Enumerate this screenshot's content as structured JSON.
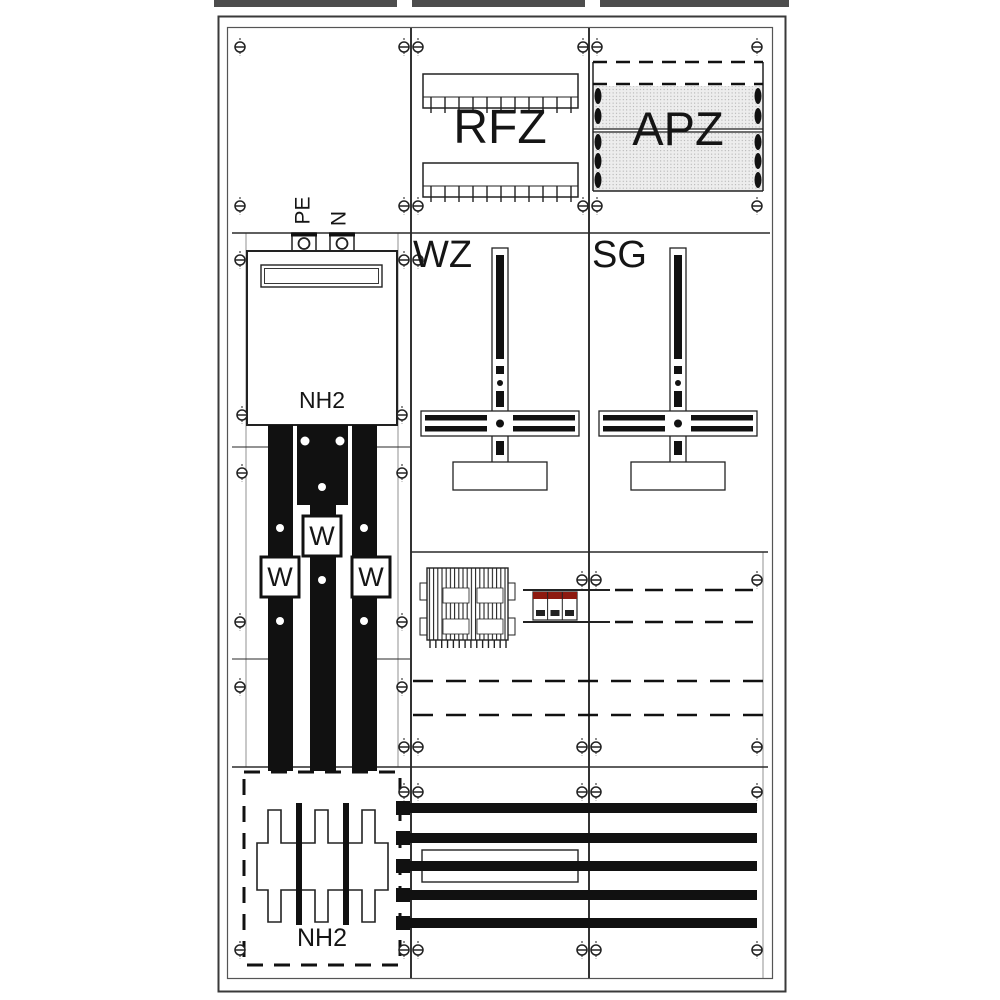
{
  "figure": {
    "type": "electrical-distribution-board-front-view",
    "labels": {
      "din_rail_field": "RFZ",
      "apz_field": "APZ",
      "meter_field_left": "WZ",
      "meter_field_right": "SG",
      "pe_terminal": "PE",
      "n_terminal": "N",
      "nh_fuse_top": "NH2",
      "nh_fuse_bottom": "NH2",
      "current_transformer": "W"
    },
    "colors": {
      "line": "#1e1e1e",
      "frame": "#3a3a3a",
      "top_band": "#4d4d4d",
      "breaker_red": "#8d1a10",
      "stipple_bg": "#ededed"
    },
    "counts": {
      "current_transformers": 3,
      "bottom_busbars": 5,
      "meter_crosses": 2,
      "din_rails": 2
    },
    "screws": [
      [
        240,
        47
      ],
      [
        404,
        47
      ],
      [
        418,
        47
      ],
      [
        583,
        47
      ],
      [
        597,
        47
      ],
      [
        757,
        47
      ],
      [
        240,
        206
      ],
      [
        404,
        206
      ],
      [
        418,
        206
      ],
      [
        583,
        206
      ],
      [
        597,
        206
      ],
      [
        757,
        206
      ],
      [
        240,
        260
      ],
      [
        404,
        260
      ],
      [
        418,
        260
      ],
      [
        242,
        415
      ],
      [
        402,
        415
      ],
      [
        242,
        473
      ],
      [
        402,
        473
      ],
      [
        582,
        580
      ],
      [
        596,
        580
      ],
      [
        757,
        580
      ],
      [
        240,
        622
      ],
      [
        402,
        622
      ],
      [
        240,
        687
      ],
      [
        402,
        687
      ],
      [
        404,
        747
      ],
      [
        418,
        747
      ],
      [
        582,
        747
      ],
      [
        596,
        747
      ],
      [
        757,
        747
      ],
      [
        404,
        792
      ],
      [
        418,
        792
      ],
      [
        582,
        792
      ],
      [
        596,
        792
      ],
      [
        757,
        792
      ],
      [
        240,
        950
      ],
      [
        404,
        950
      ],
      [
        418,
        950
      ],
      [
        582,
        950
      ],
      [
        596,
        950
      ],
      [
        757,
        950
      ]
    ],
    "tick_rows": [
      {
        "x0": 431,
        "x1": 571,
        "n": 11,
        "y0": 97,
        "y1": 113
      },
      {
        "x0": 431,
        "x1": 571,
        "n": 11,
        "y0": 186,
        "y1": 202
      },
      {
        "x0": 430,
        "x1": 506,
        "n": 14,
        "y0": 640,
        "y1": 648
      }
    ]
  }
}
